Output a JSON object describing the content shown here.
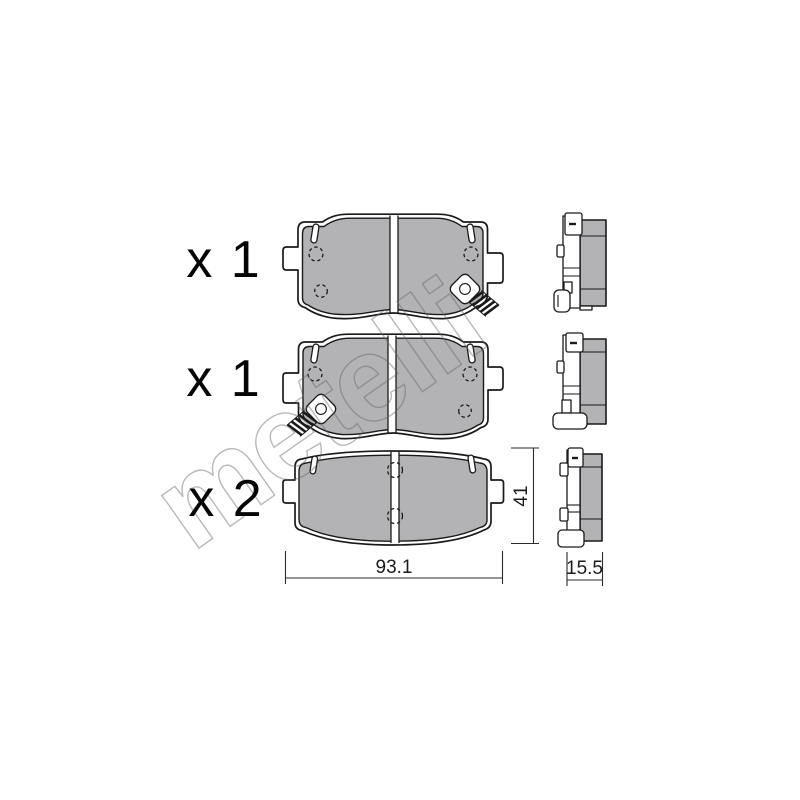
{
  "diagram": {
    "watermark_text": "metelli",
    "rows": [
      {
        "quantity_label": "x 1"
      },
      {
        "quantity_label": "x 1"
      },
      {
        "quantity_label": "x 2"
      }
    ],
    "dimensions": {
      "pad_width": "93.1",
      "pad_height": "41",
      "pad_thickness": "15.5"
    },
    "colors": {
      "friction_material_gray": "#b3b3b6",
      "outline_black": "#1a1a1a",
      "watermark_gray": "#b0b0b0",
      "background_white": "#ffffff"
    }
  }
}
